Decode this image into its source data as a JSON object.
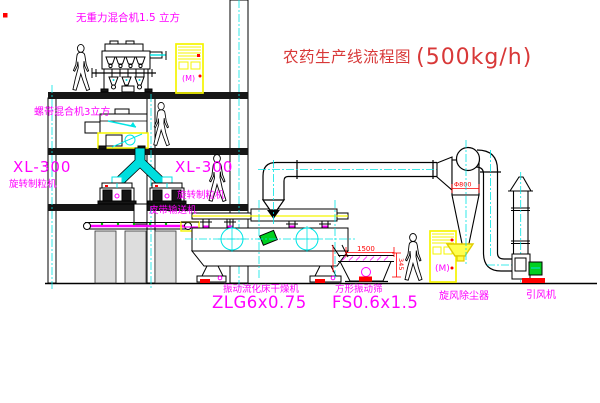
{
  "title": {
    "name": "农药生产线流程图",
    "capacity": "(500kg/h)"
  },
  "equipment_labels": {
    "gravity_free_mixer": "无重力混合机1.5 立方",
    "ribbon_mixer": "螺带混合机3立方",
    "granulator_left": {
      "model": "XL-300",
      "name": "旋转制粒机"
    },
    "granulator_center": {
      "model": "XL-300",
      "name": "旋转制粒机"
    },
    "belt_conveyor": "皮带输送机",
    "fluid_bed_dryer": {
      "name": "振动流化床干燥机",
      "model": "ZLG6x0.75"
    },
    "square_vibrating_screen": {
      "name": "方形振动筛",
      "model": "FS0.6x1.5"
    },
    "cyclone_dust_collector": "旋风除尘器",
    "induced_draft_fan": "引风机"
  },
  "dimensions": {
    "screen_length": "1500",
    "screen_height": "345",
    "cyclone_diameter": "Φ800"
  },
  "control_cabinet_text": "(M)",
  "colors": {
    "label_magenta": "#ff00ff",
    "title_red": "#d83838",
    "dimension_red": "#ff0000",
    "centerline_cyan": "#00e5e5",
    "cabinet_yellow": "#f5f500",
    "line_black": "#000000",
    "motor_green": "#00d020"
  }
}
